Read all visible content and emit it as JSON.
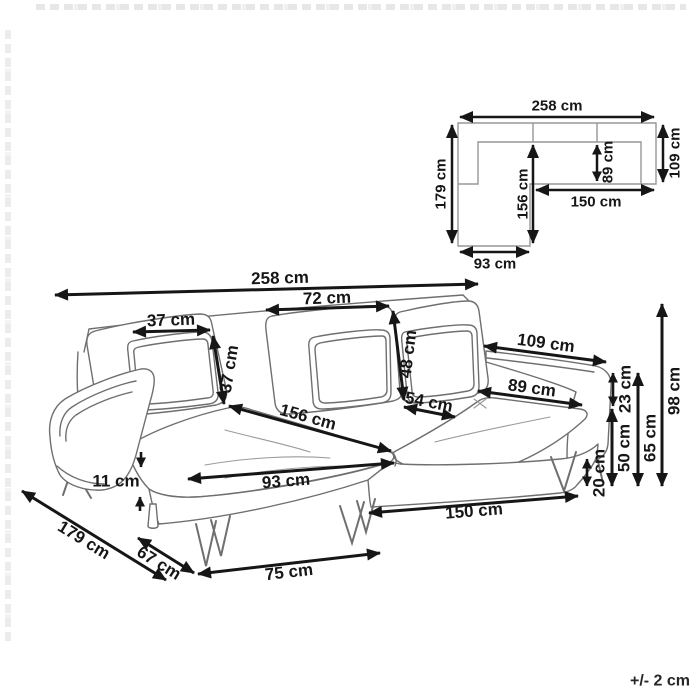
{
  "diagram": {
    "tolerance_note": "+/- 2 cm"
  },
  "plan_view": {
    "dims": {
      "total_width": "258 cm",
      "right_depth": "109 cm",
      "left_depth": "179 cm",
      "chaise_length": "156 cm",
      "seat_depth": "89 cm",
      "right_seat_width": "150 cm",
      "chaise_width": "93 cm"
    }
  },
  "sofa_view": {
    "dims": {
      "total_width": "258 cm",
      "back_cushion_width": "72 cm",
      "pillow_width": "37 cm",
      "pillow_height": "37 cm",
      "back_cushion_height": "48 cm",
      "seat_depth_front": "54 cm",
      "chaise_seat_length": "156 cm",
      "armrest_length": "109 cm",
      "seat_width": "89 cm",
      "armrest_above_seat": "23 cm",
      "seat_height": "50 cm",
      "ground_clearance": "20 cm",
      "armrest_height": "65 cm",
      "total_height": "98 cm",
      "armrest_seat_gap": "11 cm",
      "chaise_front_width": "93 cm",
      "base_front_width": "150 cm",
      "total_depth": "179 cm",
      "chaise_side_depth": "67 cm",
      "front_leg_span": "75 cm"
    }
  }
}
